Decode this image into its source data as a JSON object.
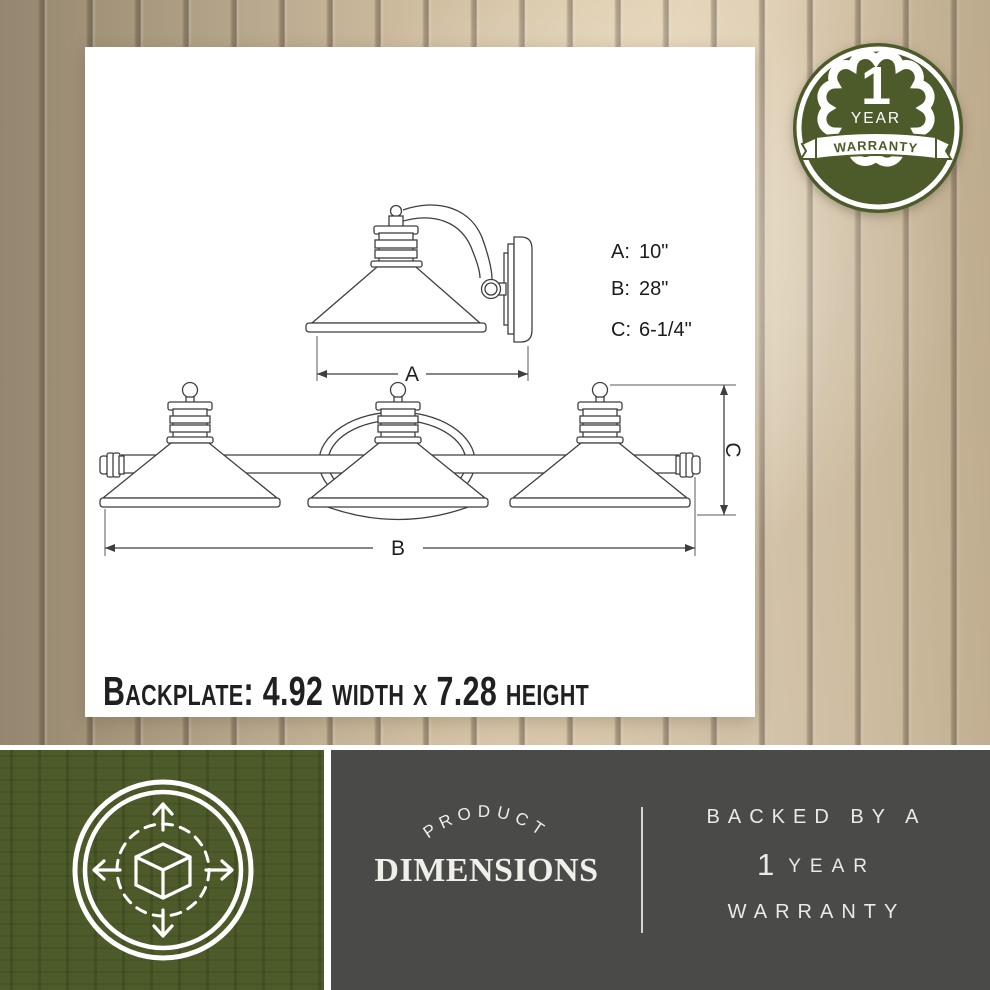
{
  "card": {
    "backplate_note": "Backplate:  4.92 width x 7.28 height",
    "dimension_specs": [
      {
        "label": "A:",
        "value": "10\""
      },
      {
        "label": "B:",
        "value": "28\""
      },
      {
        "label": "C:",
        "value": "6-1/4\""
      }
    ],
    "dim_labels": {
      "a": "A",
      "b": "B",
      "c": "C"
    }
  },
  "badge": {
    "number": "1",
    "year": "YEAR",
    "banner": "WARRANTY"
  },
  "footer": {
    "arc_title": "PRODUCT",
    "main_title": "DIMENSIONS",
    "warranty": {
      "line1": "BACKED BY A",
      "number": "1",
      "year": "YEAR",
      "line3": "WARRANTY"
    }
  },
  "colors": {
    "olive_green": "#4d5b2b",
    "charcoal": "#4a4a48",
    "wood_light": "#e6d7bf",
    "wood_dark": "#9a8c7a",
    "line_art": "#3f3f3f"
  }
}
